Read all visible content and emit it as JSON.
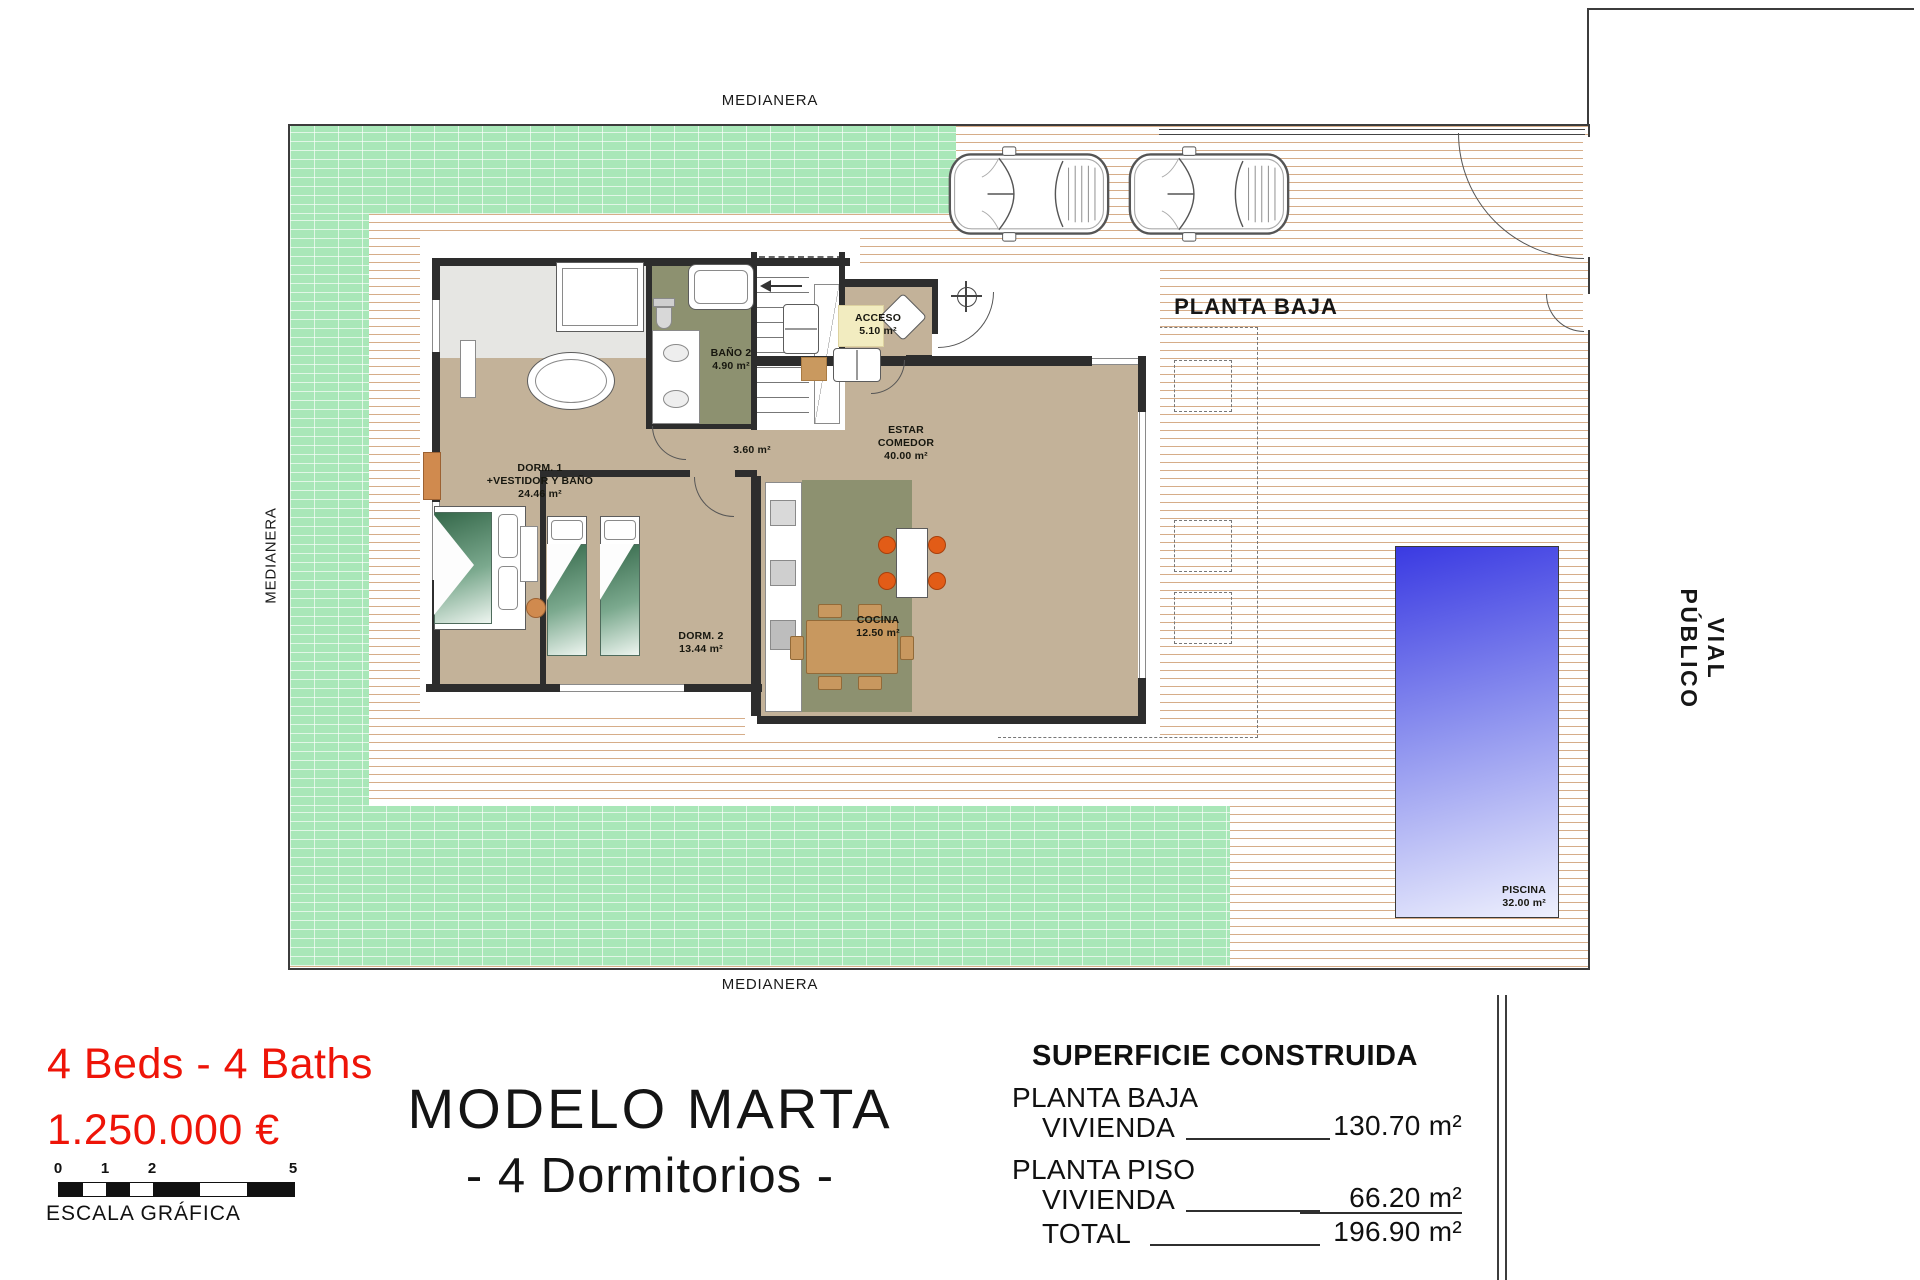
{
  "boundaries": {
    "medianera_top": "MEDIANERA",
    "medianera_left": "MEDIANERA",
    "medianera_bottom": "MEDIANERA",
    "vial_publico": "VIAL PÚBLICO",
    "planta_baja": "PLANTA BAJA"
  },
  "rooms": {
    "dorm1": {
      "line1": "DORM. 1",
      "line2": "+VESTIDOR Y BAÑO",
      "area": "24.46 m²"
    },
    "bano2": {
      "name": "BAÑO 2",
      "area": "4.90 m²"
    },
    "acceso": {
      "name": "ACCESO",
      "area": "5.10 m²"
    },
    "estar": {
      "line1": "ESTAR",
      "line2": "COMEDOR",
      "area": "40.00 m²"
    },
    "hall": {
      "area": "3.60 m²"
    },
    "cocina": {
      "name": "COCINA",
      "area": "12.50 m²"
    },
    "dorm2": {
      "name": "DORM. 2",
      "area": "13.44 m²"
    },
    "piscina": {
      "name": "PISCINA",
      "area": "32.00 m²"
    }
  },
  "info": {
    "beds_baths": "4 Beds - 4 Baths",
    "price": "1.250.000 €"
  },
  "scale_bar": {
    "ticks": [
      "0",
      "1",
      "2",
      "5"
    ],
    "caption": "ESCALA GRÁFICA"
  },
  "title": {
    "name": "MODELO MARTA",
    "subtitle": "- 4 Dormitorios -"
  },
  "table": {
    "title": "SUPERFICIE CONSTRUIDA",
    "rows": [
      {
        "label": "PLANTA BAJA",
        "sub": "VIVIENDA",
        "value": "130.70 m²"
      },
      {
        "label": "PLANTA PISO",
        "sub": "VIVIENDA",
        "value": "66.20 m²"
      },
      {
        "label": "TOTAL",
        "sub": "",
        "value": "196.90 m²"
      }
    ]
  },
  "colors": {
    "accent_red": "#ee1408",
    "grass": "#a9e7b8",
    "deck_line": "#d6ad89",
    "floor_tan": "#c3b299",
    "wet_room_green": "#8d9170",
    "wall": "#2d2d2d",
    "pool_deep": "#3a3ae2",
    "pool_shallow": "#eef0fd"
  }
}
